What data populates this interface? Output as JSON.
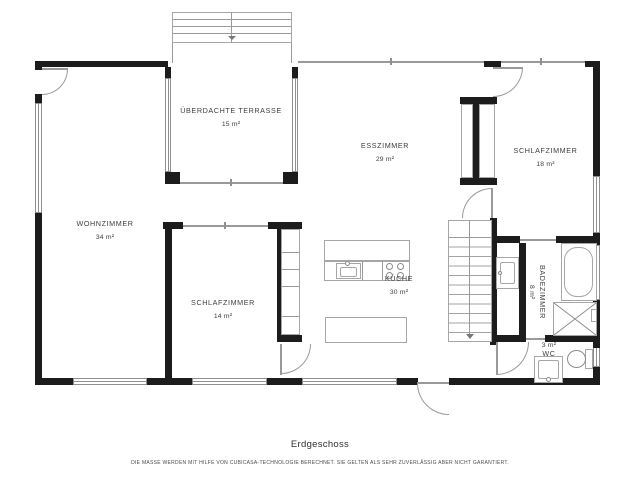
{
  "title": "Erdgeschoss",
  "disclaimer": "DIE MASSE WERDEN MIT HILFE VON CUBICASA-TECHNOLOGIE BERECHNET. SIE GELTEN ALS SEHR ZUVERLÄSSIG ABER NICHT GARANTIERT.",
  "rooms": {
    "terrace": {
      "name": "ÜBERDACHTE TERRASSE",
      "area": "15 m²"
    },
    "dining": {
      "name": "ESSZIMMER",
      "area": "29 m²"
    },
    "bedroom_right": {
      "name": "SCHLAFZIMMER",
      "area": "18 m²"
    },
    "living": {
      "name": "WOHNZIMMER",
      "area": "34 m²"
    },
    "bedroom_left": {
      "name": "SCHLAFZIMMER",
      "area": "14 m²"
    },
    "kitchen": {
      "name": "KÜCHE",
      "area": "30 m²"
    },
    "bathroom": {
      "name": "BADEZIMMER",
      "area": "8 m²"
    },
    "wc": {
      "name": "WC",
      "area": "3 m²"
    }
  },
  "colors": {
    "wall": "#1c1c1c",
    "line": "#9a9a9a",
    "text": "#3d3d3d"
  }
}
